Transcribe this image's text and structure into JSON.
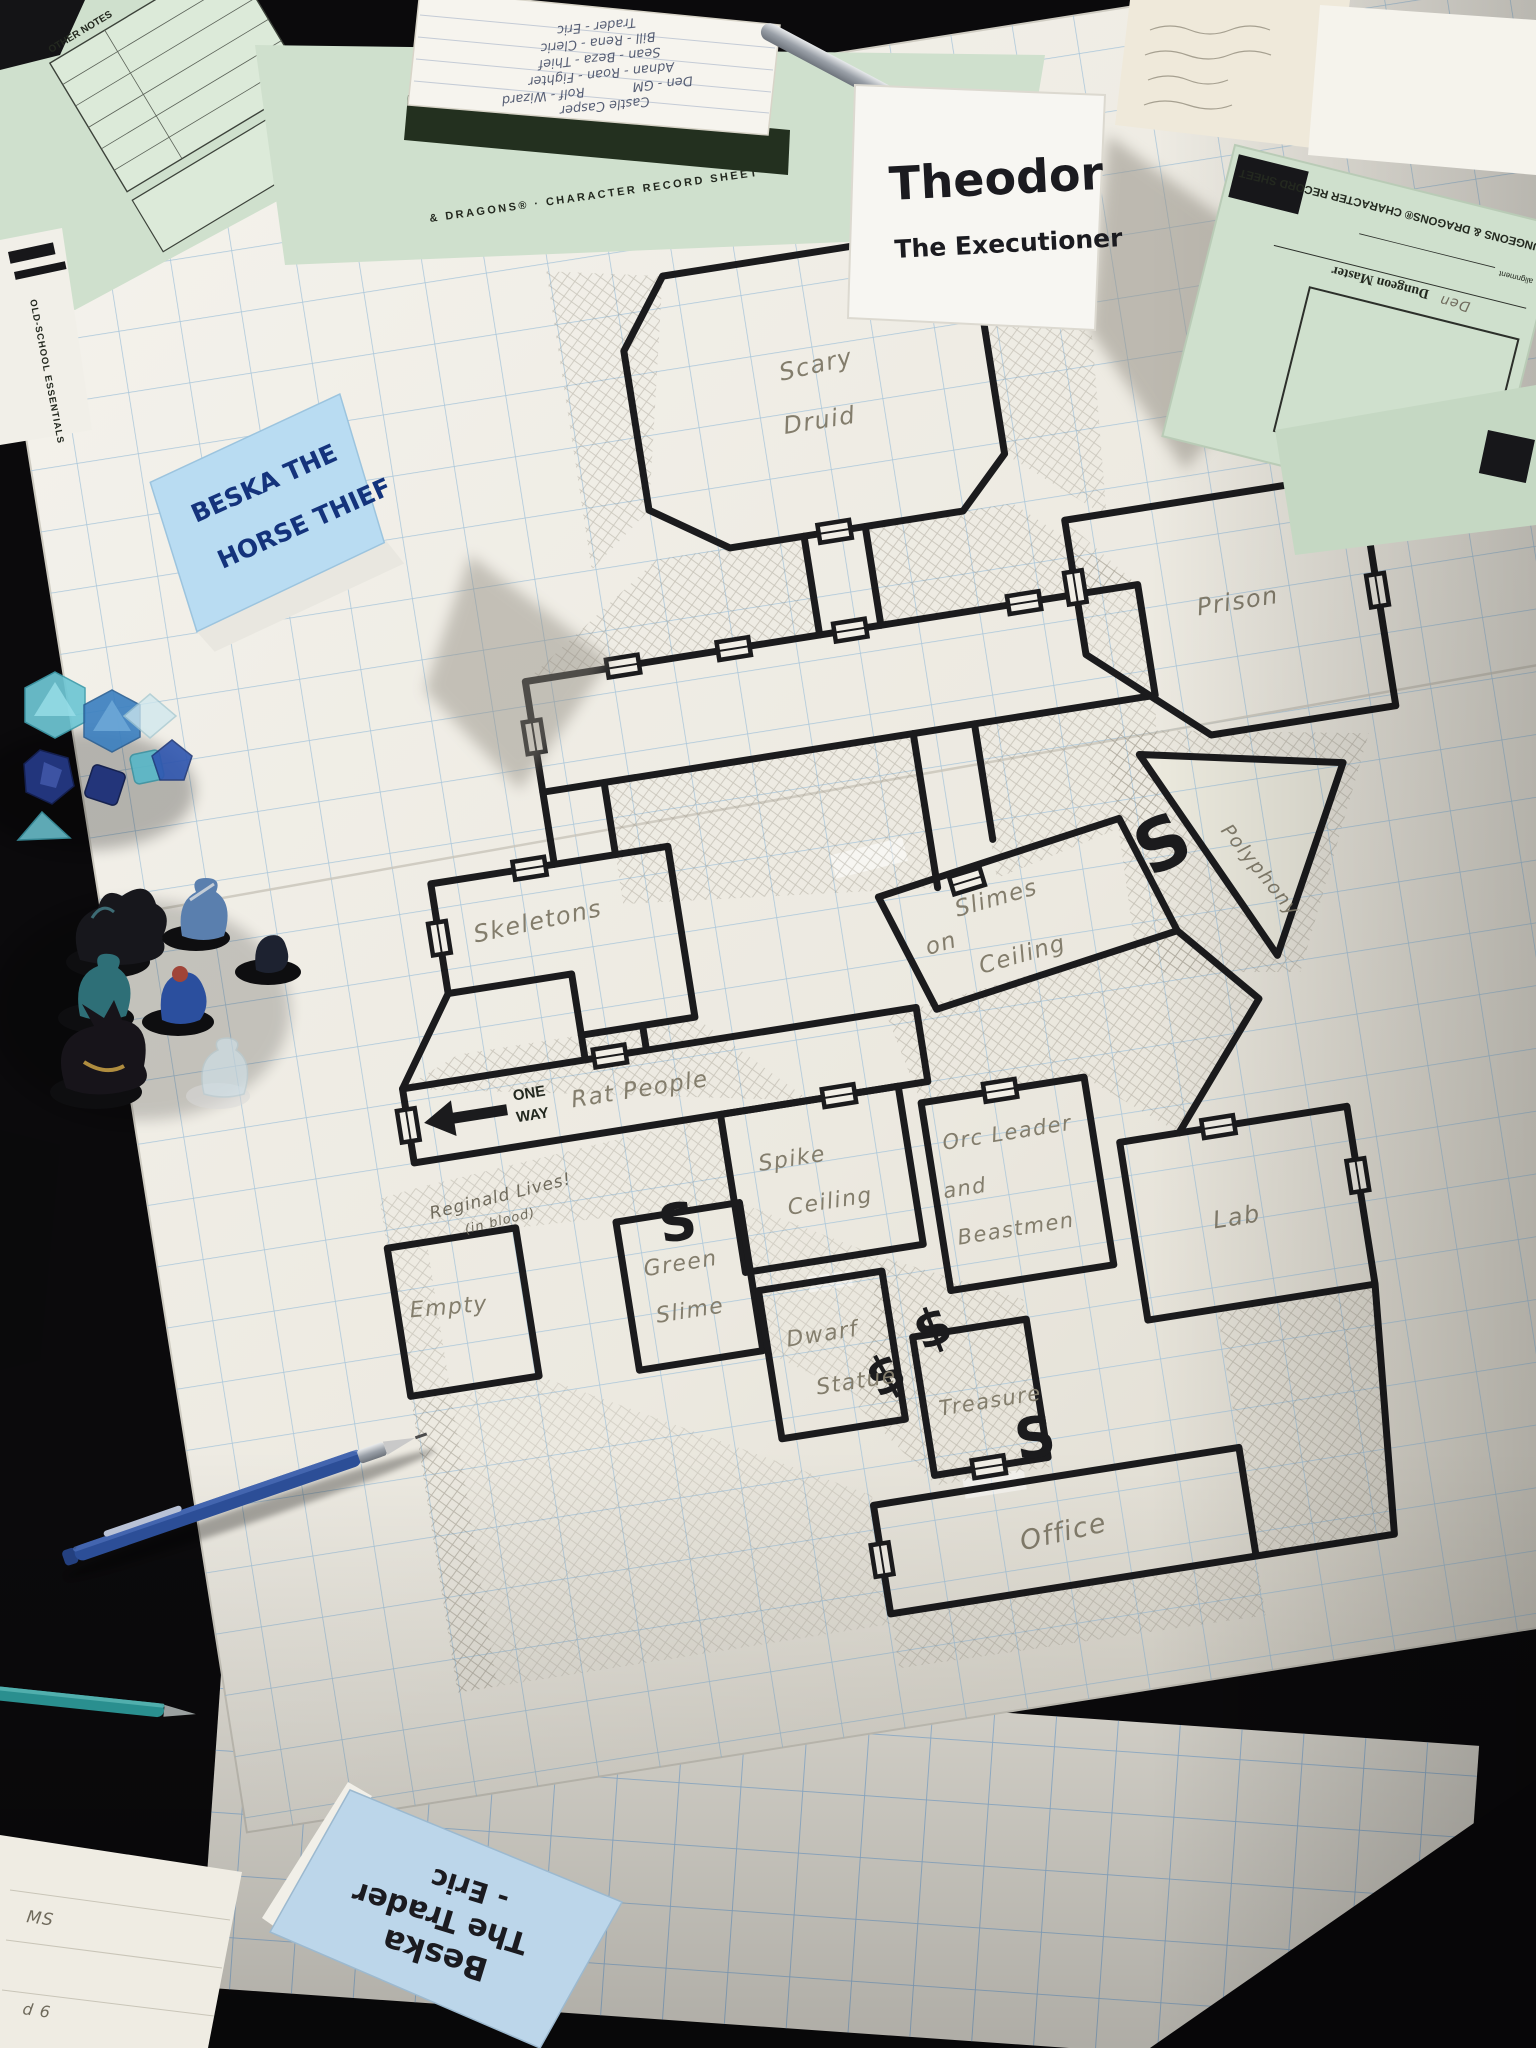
{
  "tent_cards": {
    "theodor": {
      "line1": "Theodor",
      "line2": "The Executioner"
    },
    "beska": {
      "line1": "BESKA THE",
      "line2": "HORSE THIEF"
    },
    "trader": {
      "line1": "Beska",
      "line2": "The Trader",
      "line3": "- Eric"
    }
  },
  "map": {
    "rooms": {
      "scary_1": "Scary",
      "scary_2": "Druid",
      "prison": "Prison",
      "skeletons": "Skeletons",
      "polyphony": "Polyphony",
      "slimes_1": "Slimes",
      "slimes_2": "on",
      "slimes_3": "Ceiling",
      "rat_people": "Rat People",
      "spike_1": "Spike",
      "spike_2": "Ceiling",
      "orc_1": "Orc Leader",
      "orc_2": "and",
      "orc_3": "Beastmen",
      "green_1": "Green",
      "green_2": "Slime",
      "dwarf_1": "Dwarf",
      "dwarf_2": "Statue",
      "lab": "Lab",
      "treasure": "Treasure",
      "office": "Office",
      "reginald_1": "Reginald Lives!",
      "reginald_2": "(in blood)",
      "empty": "Empty"
    },
    "marks": {
      "one_way_top": "ONE",
      "one_way_bottom": "WAY",
      "secret_door": "S",
      "treasure_sign": "$"
    }
  },
  "documents": {
    "dm_sheet": {
      "sketch_caption": "Character Sketch or Symbol",
      "role": "Dungeon Master",
      "player_name": "Den",
      "full_title": "DUNGEONS & DRAGONS® CHARACTER RECORD SHEET",
      "alignment_label": "alignment"
    },
    "record_sheet_edge": "& DRAGONS® · CHARACTER RECORD SHEET",
    "ose_sheet": {
      "title": "OLD-SCHOOL ESSENTIALS",
      "notes_header": "OTHER NOTES"
    },
    "notebook_lines": [
      "Castle Casper",
      "Den - GM",
      "Rolf - Wizard",
      "Adnan - Roan - Fighter",
      "Sean - Beza - Thief",
      "Bill - Rena - Cleric",
      "Trader - Eric"
    ],
    "fragments": {
      "bottom_left_a": "MS",
      "bottom_left_b": "d 6"
    }
  },
  "colors": {
    "paper": "#efece4",
    "grid_blue": "#a9c6da",
    "wall_ink": "#1b1b1d",
    "pencil_graphite": "#837d6c",
    "note_blue": "#b9dcf2",
    "sheet_green": "#cfe0cd",
    "marker_ink": "#1b1b20",
    "pencil_body_blue": "#2c4e97",
    "dice_teal": "#6ec6d4",
    "table_dark": "#0b0a0c"
  }
}
